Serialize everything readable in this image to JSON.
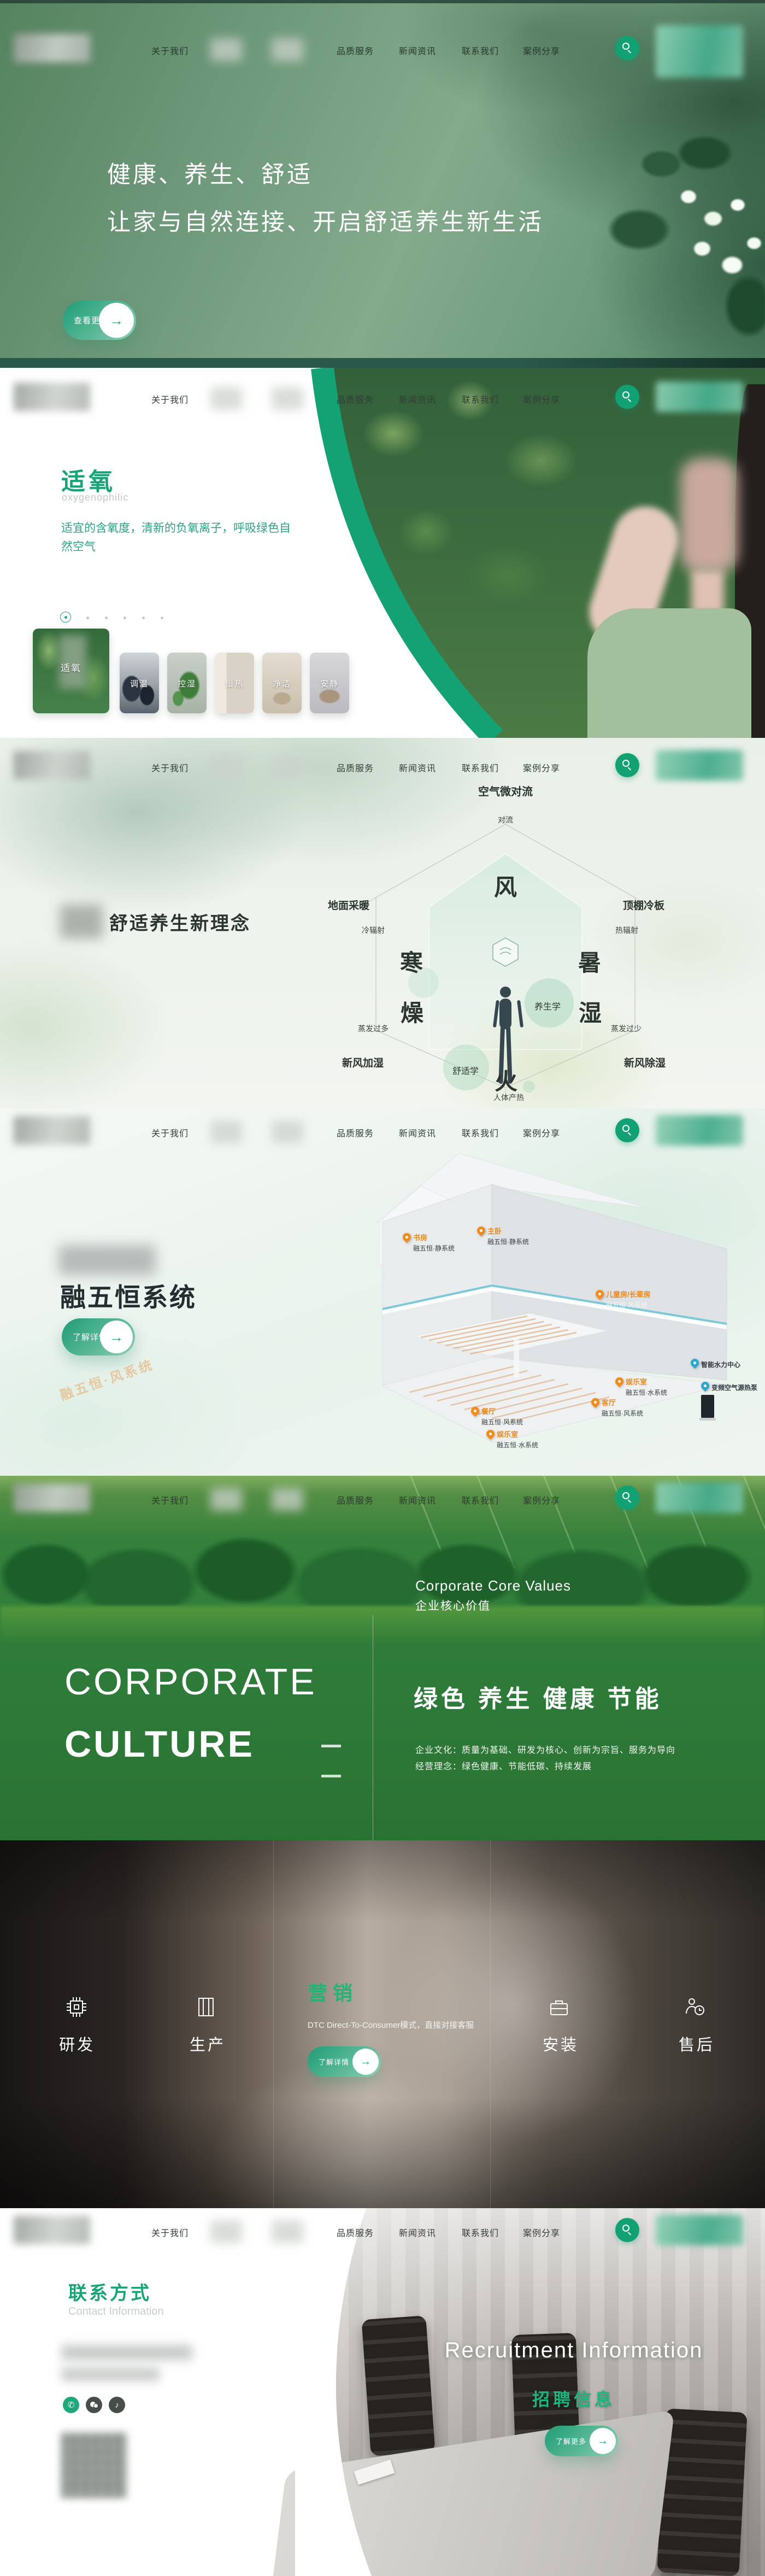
{
  "nav": {
    "about": "关于我们",
    "items": [
      "品质服务",
      "新闻资讯",
      "联系我们",
      "案例分享"
    ]
  },
  "hero": {
    "title_line1": "健康、养生、舒适",
    "title_line2": "让家与自然连接、开启舒适养生新生活",
    "cta": "查看更多",
    "arrow": "→",
    "scroll_hint": "滑动了解更多"
  },
  "oxygen": {
    "title": "适氧",
    "subtitle": "oxygenophilic",
    "desc": "适宜的含氧度，清新的负氧离子，呼吸绿色自然空气",
    "cards": [
      {
        "label": "适氧"
      },
      {
        "label": "调温"
      },
      {
        "label": "控湿"
      },
      {
        "label": "恒热"
      },
      {
        "label": "净洁"
      },
      {
        "label": "安静"
      }
    ]
  },
  "concept": {
    "heading": "舒适养生新理念",
    "top_title": "空气微对流",
    "top_sub": "对流",
    "left_title": "地面采暖",
    "left_sub": "冷辐射",
    "right_title": "顶棚冷板",
    "right_sub": "热辐射",
    "bl_sub": "蒸发过多",
    "bl_title": "新风加湿",
    "br_sub": "蒸发过少",
    "br_title": "新风除湿",
    "bottom_sub": "人体产热",
    "hex": {
      "wind": "风",
      "cold": "寒",
      "heat": "暑",
      "dry": "燥",
      "wet": "湿",
      "fire": "火"
    },
    "bubble1": "养生学",
    "bubble2": "舒适学"
  },
  "system": {
    "title": "融五恒系统",
    "cta": "了解详情",
    "watermark": "融五恒·风系统",
    "pins": [
      {
        "room": "书房",
        "sys": "融五恒·静系统"
      },
      {
        "room": "主卧",
        "sys": "融五恒·静系统"
      },
      {
        "room": "儿童房/长辈房",
        "sys": "融五恒·风系统"
      },
      {
        "room": "餐厅",
        "sys": "融五恒·风系统"
      },
      {
        "room": "客厅",
        "sys": "融五恒·风系统"
      },
      {
        "room": "娱乐室",
        "sys": "融五恒·水系统"
      },
      {
        "room": "娱乐室",
        "sys": "融五恒·水系统"
      }
    ],
    "devices": [
      "智能水力中心",
      "变频空气源热泵"
    ]
  },
  "culture": {
    "en_label": "Corporate Core Values",
    "cn_label": "企业核心价值",
    "big1": "CORPORATE",
    "big2": "CULTURE",
    "slogan": "绿色 养生 健康 节能",
    "line1": "企业文化：质量为基础、研发为核心、创新为宗旨、服务为导向",
    "line2": "经营理念：绿色健康、节能低碳、持续发展"
  },
  "services": {
    "items": [
      "研发",
      "生产",
      "营销",
      "安装",
      "售后"
    ],
    "active": "营销",
    "active_desc": "DTC Direct-To-Consumer模式，直接对接客服",
    "cta": "了解详情"
  },
  "contact": {
    "title": "联系方式",
    "subtitle": "Contact Information",
    "phone_glyph": "✆",
    "recruit_en": "Recruitment Information",
    "recruit_cn": "招聘信息",
    "cta": "了解更多"
  },
  "colors": {
    "accent": "#14a173",
    "accent_light": "#1db57d",
    "pin_orange": "#f08c1e",
    "pin_blue": "#2ea7cf"
  }
}
